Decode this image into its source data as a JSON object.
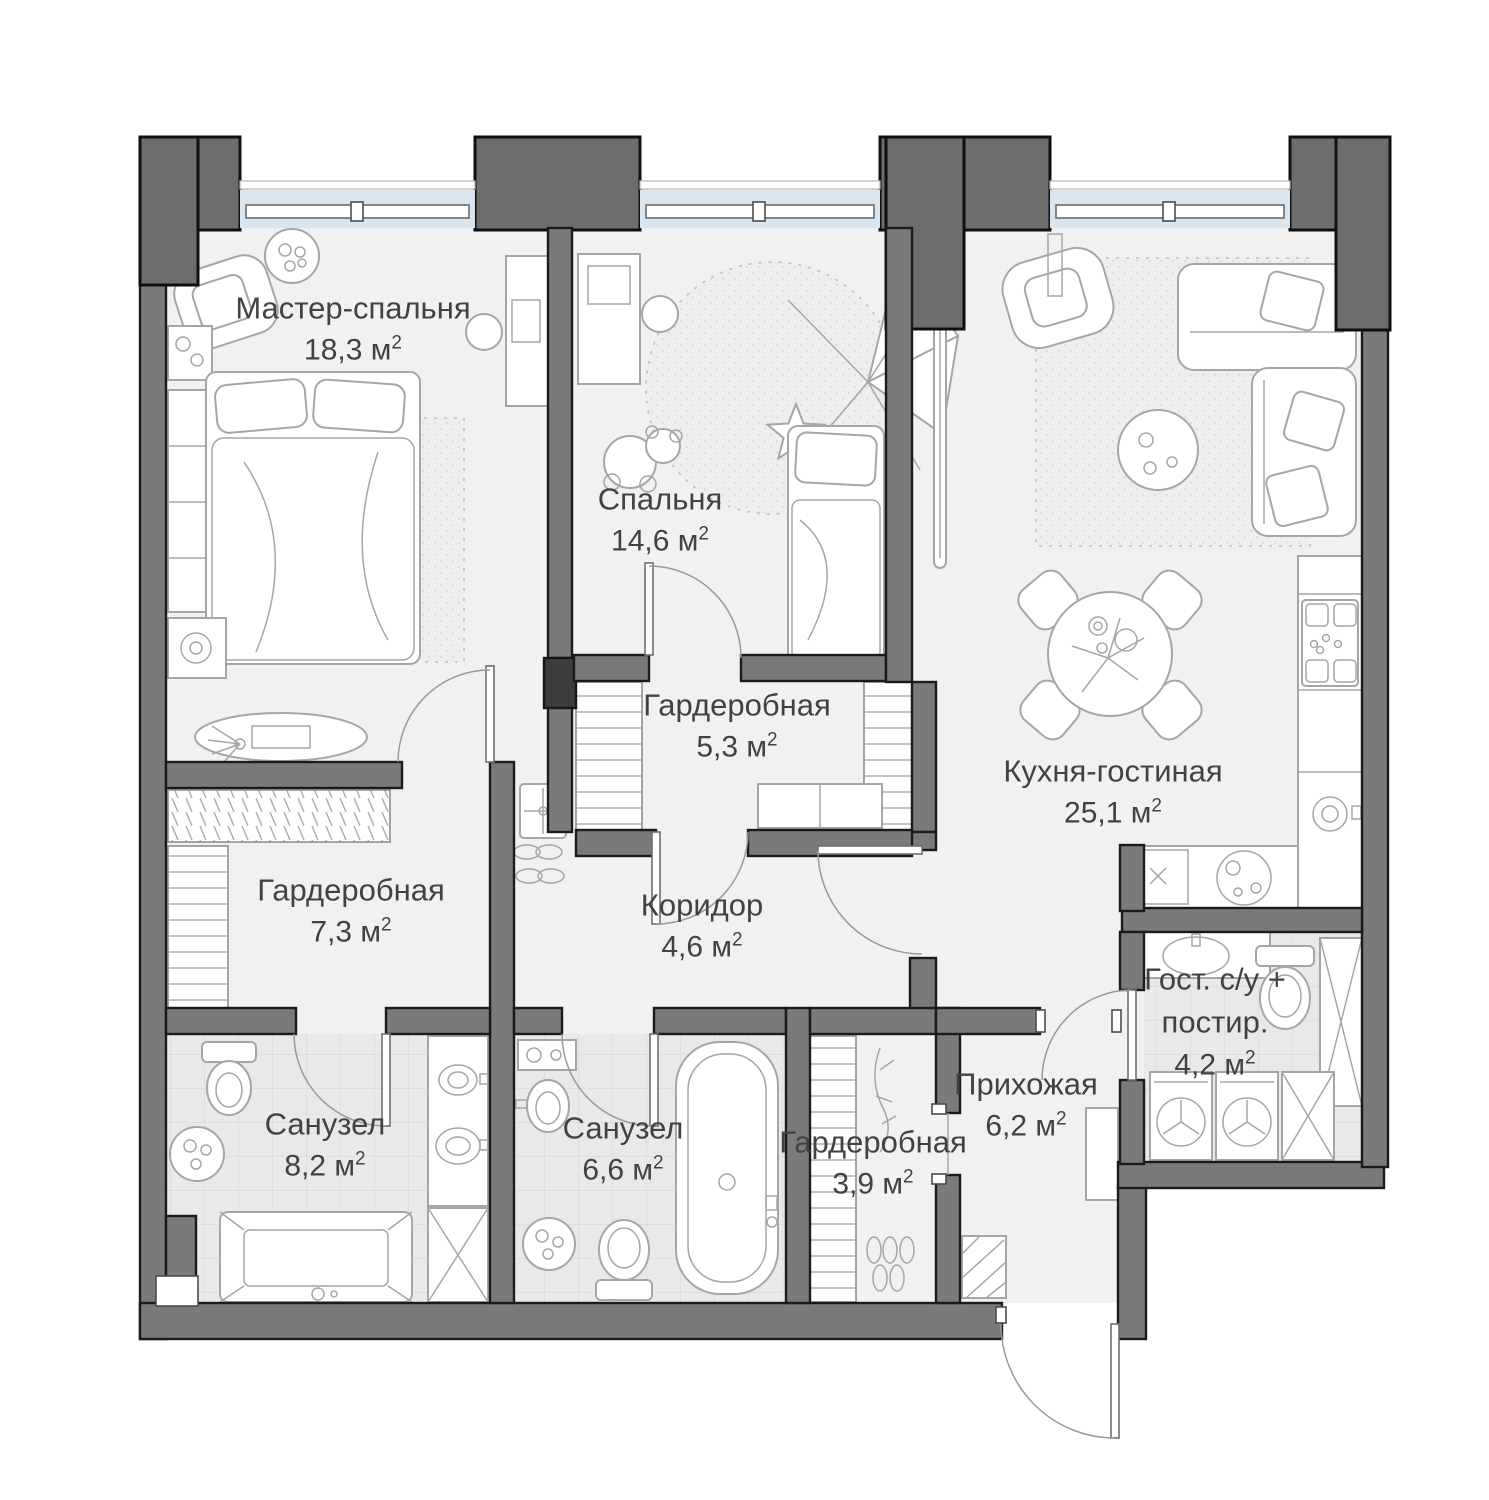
{
  "colors": {
    "wall": "#7a7a7a",
    "column": "#6d6d6d",
    "floor": "#f1f1f1",
    "window": "#d9e6f0",
    "text": "#424242",
    "line": "#a6a6a6"
  },
  "rooms": [
    {
      "id": "master-bedroom",
      "name": "Мастер-спальня",
      "area": "18,3 м",
      "sup": "2"
    },
    {
      "id": "bedroom",
      "name": "Спальня",
      "area": "14,6 м",
      "sup": "2"
    },
    {
      "id": "wardrobe-1",
      "name": "Гардеробная",
      "area": "5,3 м",
      "sup": "2"
    },
    {
      "id": "kitchen-living",
      "name": "Кухня-гостиная",
      "area": "25,1 м",
      "sup": "2"
    },
    {
      "id": "wardrobe-2",
      "name": "Гардеробная",
      "area": "7,3 м",
      "sup": "2"
    },
    {
      "id": "corridor",
      "name": "Коридор",
      "area": "4,6 м",
      "sup": "2"
    },
    {
      "id": "bathroom-1",
      "name": "Санузел",
      "area": "8,2 м",
      "sup": "2"
    },
    {
      "id": "bathroom-2",
      "name": "Санузел",
      "area": "6,6 м",
      "sup": "2"
    },
    {
      "id": "wardrobe-3",
      "name": "Гардеробная",
      "area": "3,9 м",
      "sup": "2"
    },
    {
      "id": "hallway",
      "name": "Прихожая",
      "area": "6,2 м",
      "sup": "2"
    },
    {
      "id": "guest-bathroom",
      "name": "Гост. с/у + постир.",
      "area": "4,2 м",
      "sup": "2"
    }
  ]
}
